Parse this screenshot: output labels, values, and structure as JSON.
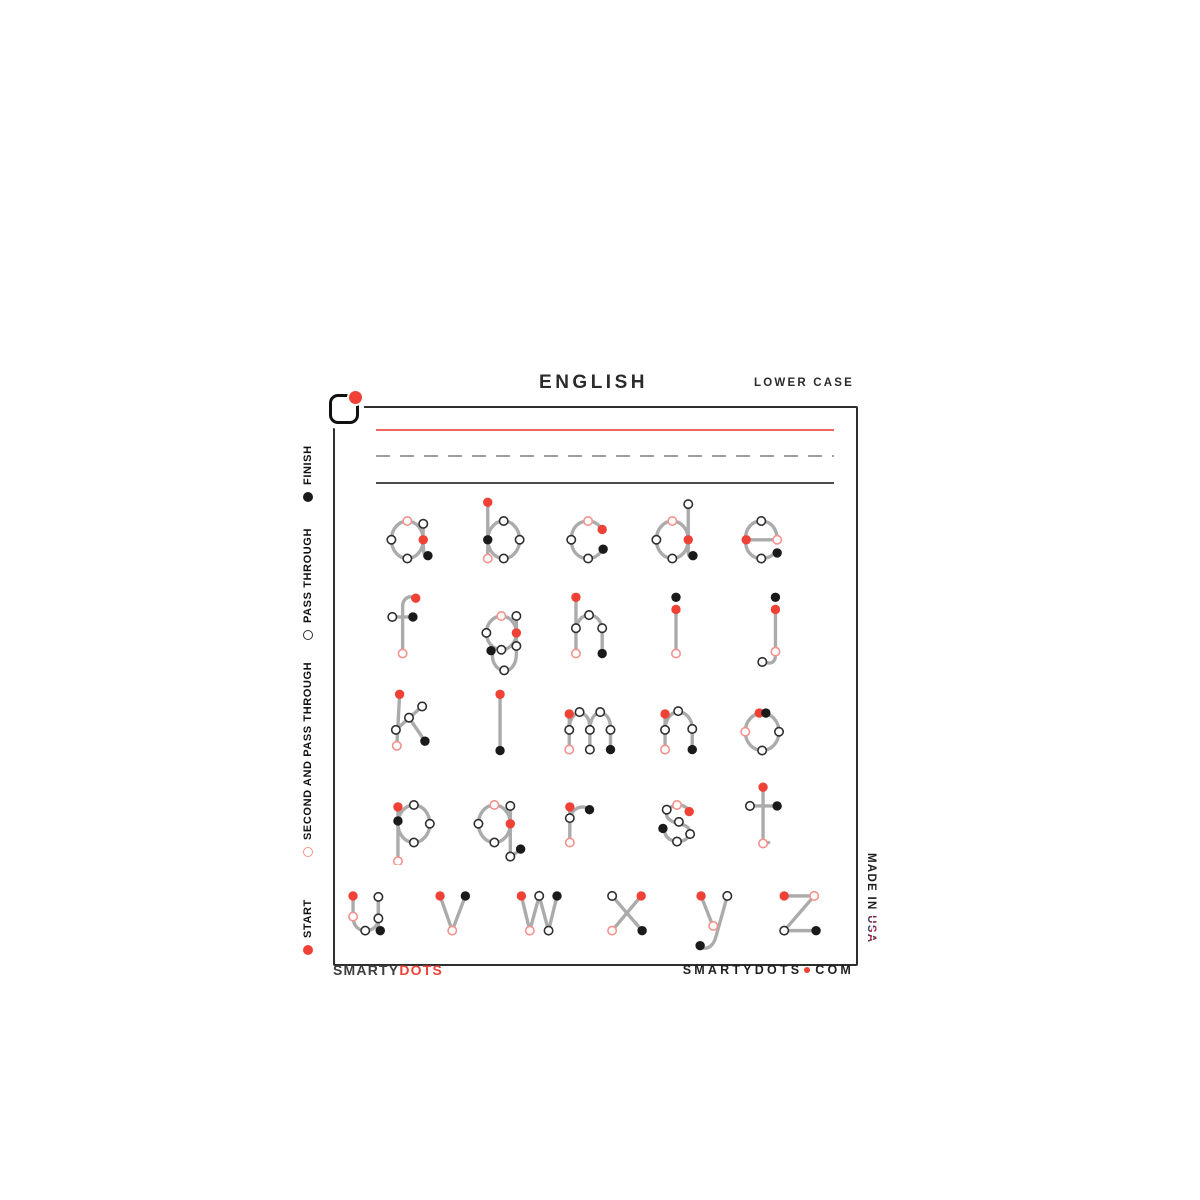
{
  "header": {
    "title": "ENGLISH",
    "subtitle": "LOWER CASE"
  },
  "colors": {
    "start": "#ef4136",
    "finish": "#1a1a1a",
    "pass_ring": "#2f2f2f",
    "second_ring": "#f5928c",
    "stroke": "#ababab",
    "rule_red": "#f0655c",
    "rule_dash": "#9e9e9e",
    "rule_solid": "#4e4e4e",
    "frame": "#2e2e2e"
  },
  "legend": {
    "items": [
      {
        "type": "finish",
        "label": "FINISH"
      },
      {
        "type": "pass",
        "label": "PASS THROUGH"
      },
      {
        "type": "second",
        "label": "SECOND AND PASS THROUGH"
      },
      {
        "type": "start",
        "label": "START"
      }
    ]
  },
  "footer": {
    "brand_left_1": "SMARTY",
    "brand_left_2": "DOTS",
    "site_name": "SMARTYDOTS",
    "site_tld": "COM",
    "made_in": "MADE IN ",
    "made_in_country": "USA"
  },
  "letters": [
    {
      "char": "a",
      "cx": 412,
      "baseline": 558,
      "strokes": [
        "M10,52 a17,20 0 1 0 34,0 a17,20 0 1 0 -34,0",
        "M44,34 C44,48 43,58 45,67 C46,71 49,71 50,69"
      ],
      "dots": [
        [
          "second",
          27,
          32
        ],
        [
          "pass",
          10,
          52
        ],
        [
          "pass",
          27,
          72
        ],
        [
          "pass",
          44,
          35
        ],
        [
          "start",
          44,
          52
        ],
        [
          "finish",
          49,
          69
        ]
      ]
    },
    {
      "char": "b",
      "cx": 499,
      "baseline": 558,
      "strokes": [
        "M20,12 L20,72",
        "M20,52 a17,20 0 1 0 34,0 a17,20 0 1 0 -34,0"
      ],
      "dots": [
        [
          "start",
          20,
          12
        ],
        [
          "pass",
          37,
          32
        ],
        [
          "pass",
          54,
          52
        ],
        [
          "pass",
          37,
          72
        ],
        [
          "finish",
          20,
          52
        ],
        [
          "second",
          20,
          72
        ]
      ]
    },
    {
      "char": "c",
      "cx": 590,
      "baseline": 558,
      "strokes": [
        "M45,41 C41,35 36,32 30,32 C19,32 12,40 12,52 C12,64 19,72 30,72 C36,72 41,69 45,63"
      ],
      "dots": [
        [
          "second",
          30,
          32
        ],
        [
          "start",
          45,
          41
        ],
        [
          "pass",
          12,
          52
        ],
        [
          "pass",
          30,
          72
        ],
        [
          "finish",
          46,
          62
        ]
      ]
    },
    {
      "char": "d",
      "cx": 677,
      "baseline": 558,
      "strokes": [
        "M10,52 a17,20 0 1 0 34,0 a17,20 0 1 0 -34,0",
        "M44,12 L44,66 C44,70 47,71 49,69"
      ],
      "dots": [
        [
          "second",
          27,
          32
        ],
        [
          "pass",
          10,
          52
        ],
        [
          "pass",
          27,
          72
        ],
        [
          "pass",
          44,
          14
        ],
        [
          "start",
          44,
          52
        ],
        [
          "finish",
          49,
          69
        ]
      ]
    },
    {
      "char": "e",
      "cx": 765,
      "baseline": 558,
      "strokes": [
        "M12,52 L45,52",
        "M45,52 C45,40 38,32 28,32 C18,32 11,40 11,52 C11,64 18,72 28,72 C34,72 39,70 42,66"
      ],
      "dots": [
        [
          "start",
          12,
          52
        ],
        [
          "second",
          45,
          52
        ],
        [
          "pass",
          28,
          32
        ],
        [
          "pass",
          28,
          72
        ],
        [
          "finish",
          45,
          66
        ]
      ]
    },
    {
      "char": "f",
      "cx": 412,
      "baseline": 653,
      "strokes": [
        "M36,13 C28,9 22,14 22,22 L22,72",
        "M11,33 L33,33"
      ],
      "dots": [
        [
          "start",
          36,
          13
        ],
        [
          "pass",
          11,
          33
        ],
        [
          "finish",
          33,
          33
        ],
        [
          "second",
          22,
          72
        ]
      ]
    },
    {
      "char": "g",
      "cx": 507,
      "baseline": 653,
      "strokes": [
        "M10,50 a16,18 0 1 0 32,0 a16,18 0 1 0 -32,0",
        "M42,32 L42,72 C42,85 35,92 27,90 C20,88 15,80 17,71"
      ],
      "dots": [
        [
          "second",
          26,
          32
        ],
        [
          "pass",
          42,
          32
        ],
        [
          "pass",
          10,
          50
        ],
        [
          "start",
          42,
          50
        ],
        [
          "pass",
          26,
          68
        ],
        [
          "pass",
          42,
          64
        ],
        [
          "pass",
          29,
          90
        ],
        [
          "finish",
          15,
          69
        ]
      ]
    },
    {
      "char": "h",
      "cx": 590,
      "baseline": 653,
      "strokes": [
        "M17,12 L17,72",
        "M17,50 C17,38 23,31 31,31 C39,31 45,38 45,48 L45,72"
      ],
      "dots": [
        [
          "start",
          17,
          12
        ],
        [
          "pass",
          17,
          45
        ],
        [
          "pass",
          31,
          31
        ],
        [
          "pass",
          45,
          45
        ],
        [
          "second",
          17,
          72
        ],
        [
          "finish",
          45,
          72
        ]
      ]
    },
    {
      "char": "i",
      "cx": 676,
      "baseline": 653,
      "strokes": [
        "M32,26 L32,72"
      ],
      "dots": [
        [
          "finish",
          32,
          12
        ],
        [
          "start",
          32,
          25
        ],
        [
          "second",
          32,
          72
        ]
      ]
    },
    {
      "char": "j",
      "cx": 767,
      "baseline": 653,
      "strokes": [
        "M41,26 L41,74 C41,81 36,84 30,81"
      ],
      "dots": [
        [
          "finish",
          41,
          12
        ],
        [
          "start",
          41,
          25
        ],
        [
          "second",
          41,
          70
        ],
        [
          "pass",
          27,
          81
        ]
      ]
    },
    {
      "char": "k",
      "cx": 409,
      "baseline": 750,
      "strokes": [
        "M22,12 L19,67",
        "M18,50 L46,25",
        "M32,37 L49,62"
      ],
      "dots": [
        [
          "start",
          22,
          12
        ],
        [
          "pass",
          18,
          50
        ],
        [
          "pass",
          46,
          25
        ],
        [
          "pass",
          32,
          37
        ],
        [
          "second",
          19,
          67
        ],
        [
          "finish",
          49,
          62
        ]
      ]
    },
    {
      "char": "l",
      "cx": 501,
      "baseline": 750,
      "strokes": [
        "M31,12 L31,72"
      ],
      "dots": [
        [
          "start",
          31,
          12
        ],
        [
          "finish",
          31,
          72
        ]
      ]
    },
    {
      "char": "m",
      "cx": 588,
      "baseline": 750,
      "strokes": [
        "M12,32 L12,72",
        "M12,50 C12,40 16,32 23,32 C30,32 34,39 34,48 L34,72",
        "M34,50 C34,40 38,32 45,32 C52,32 56,39 56,48 L56,72"
      ],
      "dots": [
        [
          "start",
          12,
          33
        ],
        [
          "pass",
          23,
          31
        ],
        [
          "pass",
          45,
          31
        ],
        [
          "pass",
          12,
          50
        ],
        [
          "pass",
          34,
          50
        ],
        [
          "pass",
          56,
          50
        ],
        [
          "second",
          12,
          71
        ],
        [
          "pass",
          34,
          71
        ],
        [
          "finish",
          56,
          71
        ]
      ]
    },
    {
      "char": "n",
      "cx": 681,
      "baseline": 750,
      "strokes": [
        "M15,32 L15,72",
        "M15,50 C15,39 21,31 29,31 C38,31 44,39 44,49 L44,72"
      ],
      "dots": [
        [
          "start",
          15,
          33
        ],
        [
          "pass",
          29,
          30
        ],
        [
          "pass",
          15,
          50
        ],
        [
          "pass",
          44,
          49
        ],
        [
          "second",
          15,
          71
        ],
        [
          "finish",
          44,
          71
        ]
      ]
    },
    {
      "char": "o",
      "cx": 764,
      "baseline": 750,
      "strokes": [
        "M12,52 a18,20 0 1 0 36,0 a18,20 0 1 0 -36,0"
      ],
      "dots": [
        [
          "start",
          27,
          32
        ],
        [
          "finish",
          34,
          32
        ],
        [
          "second",
          12,
          52
        ],
        [
          "pass",
          48,
          52
        ],
        [
          "pass",
          30,
          72
        ]
      ]
    },
    {
      "char": "p",
      "cx": 412,
      "baseline": 842,
      "strokes": [
        "M17,34 L17,92",
        "M17,52 a17,20 0 1 0 34,0 a17,20 0 1 0 -34,0"
      ],
      "dots": [
        [
          "start",
          17,
          34
        ],
        [
          "pass",
          34,
          32
        ],
        [
          "pass",
          51,
          52
        ],
        [
          "pass",
          34,
          72
        ],
        [
          "finish",
          17,
          49
        ],
        [
          "second",
          17,
          92
        ]
      ]
    },
    {
      "char": "q",
      "cx": 500,
      "baseline": 842,
      "strokes": [
        "M9,52 a17,20 0 1 0 34,0 a17,20 0 1 0 -34,0",
        "M43,34 L43,88 L54,79"
      ],
      "dots": [
        [
          "second",
          26,
          32
        ],
        [
          "pass",
          43,
          33
        ],
        [
          "pass",
          9,
          52
        ],
        [
          "start",
          43,
          52
        ],
        [
          "pass",
          26,
          72
        ],
        [
          "pass",
          43,
          87
        ],
        [
          "finish",
          54,
          79
        ]
      ]
    },
    {
      "char": "r",
      "cx": 582,
      "baseline": 842,
      "strokes": [
        "M19,34 L19,72",
        "M19,50 C19,40 25,34 33,34 C36,34 38,35 40,38"
      ],
      "dots": [
        [
          "start",
          19,
          34
        ],
        [
          "pass",
          19,
          46
        ],
        [
          "second",
          19,
          72
        ],
        [
          "finish",
          40,
          37
        ]
      ]
    },
    {
      "char": "s",
      "cx": 677,
      "baseline": 842,
      "strokes": [
        "M45,39 C42,32 33,30 26,34 C19,38 19,45 26,49 C33,53 42,52 45,58 C48,65 41,71 33,71 C26,71 20,67 19,61"
      ],
      "dots": [
        [
          "second",
          32,
          32
        ],
        [
          "start",
          45,
          39
        ],
        [
          "pass",
          21,
          37
        ],
        [
          "pass",
          34,
          50
        ],
        [
          "finish",
          17,
          57
        ],
        [
          "pass",
          32,
          71
        ],
        [
          "pass",
          46,
          63
        ]
      ]
    },
    {
      "char": "t",
      "cx": 764,
      "baseline": 842,
      "strokes": [
        "M31,13 L31,68 C31,73 34,74 37,72",
        "M17,33 L46,33"
      ],
      "dots": [
        [
          "start",
          31,
          13
        ],
        [
          "pass",
          17,
          33
        ],
        [
          "finish",
          46,
          33
        ],
        [
          "second",
          31,
          73
        ]
      ]
    },
    {
      "char": "u",
      "cx": 369,
      "baseline": 932,
      "strokes": [
        "M15,33 L15,55 C15,65 21,70 28,70 C36,70 42,65 42,57 L42,34",
        "M42,33 L42,70"
      ],
      "dots": [
        [
          "start",
          15,
          33
        ],
        [
          "second",
          15,
          55
        ],
        [
          "pass",
          28,
          70
        ],
        [
          "pass",
          42,
          57
        ],
        [
          "pass",
          42,
          34
        ],
        [
          "finish",
          44,
          70
        ]
      ]
    },
    {
      "char": "v",
      "cx": 456,
      "baseline": 932,
      "strokes": [
        "M15,33 L28,70 L42,33"
      ],
      "dots": [
        [
          "start",
          15,
          33
        ],
        [
          "second",
          28,
          70
        ],
        [
          "finish",
          42,
          33
        ]
      ]
    },
    {
      "char": "w",
      "cx": 542,
      "baseline": 932,
      "strokes": [
        "M10,33 L19,70 L29,33 L39,70 L48,33"
      ],
      "dots": [
        [
          "start",
          10,
          33
        ],
        [
          "second",
          19,
          70
        ],
        [
          "pass",
          29,
          33
        ],
        [
          "pass",
          39,
          70
        ],
        [
          "finish",
          48,
          33
        ]
      ]
    },
    {
      "char": "x",
      "cx": 629,
      "baseline": 932,
      "strokes": [
        "M45,33 L14,70",
        "M14,33 L46,70"
      ],
      "dots": [
        [
          "pass",
          14,
          33
        ],
        [
          "start",
          45,
          33
        ],
        [
          "second",
          14,
          70
        ],
        [
          "finish",
          46,
          70
        ]
      ]
    },
    {
      "char": "y",
      "cx": 717,
      "baseline": 932,
      "strokes": [
        "M15,33 L28,66",
        "M43,33 L31,76 C28,88 19,92 14,86"
      ],
      "dots": [
        [
          "start",
          15,
          33
        ],
        [
          "pass",
          43,
          33
        ],
        [
          "second",
          28,
          65
        ],
        [
          "finish",
          14,
          86
        ]
      ]
    },
    {
      "char": "z",
      "cx": 802,
      "baseline": 932,
      "strokes": [
        "M13,33 L45,33 L13,70 L47,70"
      ],
      "dots": [
        [
          "start",
          13,
          33
        ],
        [
          "second",
          45,
          33
        ],
        [
          "pass",
          13,
          70
        ],
        [
          "finish",
          47,
          70
        ]
      ]
    }
  ]
}
